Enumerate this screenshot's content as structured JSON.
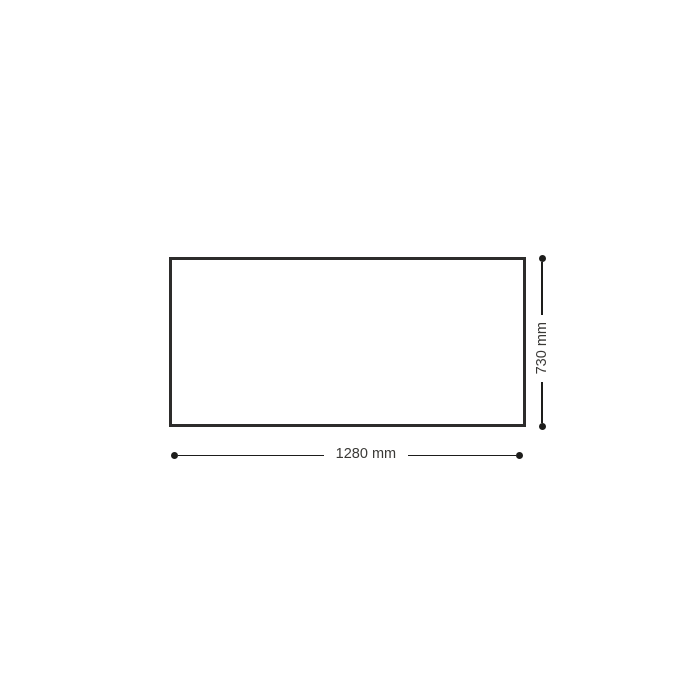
{
  "diagram": {
    "type": "technical-dimension-drawing",
    "shape": "rectangle",
    "dimensions": {
      "width_label": "1280 mm",
      "height_label": "730 mm"
    },
    "colors": {
      "background": "#ffffff",
      "panel_stroke": "#2d2c2b",
      "panel_fill": "#ffffff",
      "line_color": "#1d1d1b",
      "text_color": "#3a3936"
    }
  }
}
